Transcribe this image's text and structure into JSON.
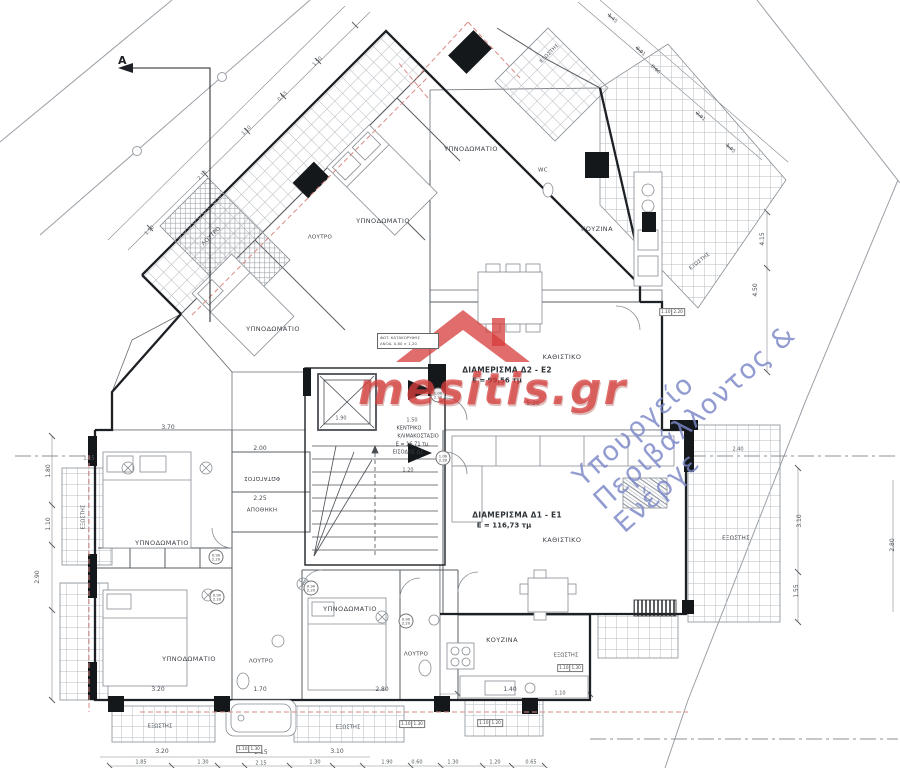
{
  "watermarks": {
    "brand": "mesitis.gr",
    "ministry": "Υπουργείο Περιβάλλοντος & Ενέργε",
    "brand_color": "#d63e3c",
    "ministry_color": "#7a86c7"
  },
  "section_marker": {
    "label": "A"
  },
  "annotation": {
    "line1": "ΦΩΤ. ΚΑΤΑΚΟΡΥΦΗΣ",
    "line2": "ΑΝΟΔ. 0,80 × 1,20"
  },
  "apartments": [
    {
      "name": "ΔΙΑΜΕΡΙΣΜΑ Δ2 - Ε2",
      "area": "Ε = 99,56 τμ"
    },
    {
      "name": "ΔΙΑΜΕΡΙΣΜΑ Δ1 - Ε1",
      "area": "Ε = 116,73 τμ"
    }
  ],
  "stair": {
    "name": "ΚΕΝΤΡΙΚΟ ΚΛΙΜΑΚΟΣΤΑΣΙΟ",
    "area": "Ε = 16,71 τμ",
    "entrance": "ΕΙΣΟΔΟΣ Δ1"
  },
  "labels": [
    {
      "name": "room-bedroom-u1",
      "text": "ΥΠΝΟΔΩΜΑΤΙΟ",
      "x": 273,
      "y": 329,
      "rot": 0,
      "cls": "room"
    },
    {
      "name": "room-bedroom-u2",
      "text": "ΥΠΝΟΔΩΜΑΤΙΟ",
      "x": 383,
      "y": 221,
      "rot": 0,
      "cls": "room"
    },
    {
      "name": "room-bedroom-u3",
      "text": "ΥΠΝΟΔΩΜΑΤΙΟ",
      "x": 471,
      "y": 149,
      "rot": 0,
      "cls": "room"
    },
    {
      "name": "room-bath-u1",
      "text": "ΛΟΥΤΡΟ",
      "x": 212,
      "y": 237,
      "rot": -45,
      "cls": "room-sm"
    },
    {
      "name": "room-bath-u2",
      "text": "ΛΟΥΤΡΟ",
      "x": 320,
      "y": 238,
      "rot": 0,
      "cls": "room-sm"
    },
    {
      "name": "room-wc-u",
      "text": "WC",
      "x": 543,
      "y": 171,
      "rot": 0,
      "cls": "room-sm"
    },
    {
      "name": "room-kitchen-u",
      "text": "ΚΟΥΖΙΝΑ",
      "x": 597,
      "y": 229,
      "rot": 0,
      "cls": "room"
    },
    {
      "name": "room-living-u",
      "text": "ΚΑΘΙΣΤΙΚΟ",
      "x": 562,
      "y": 357,
      "rot": 0,
      "cls": "room"
    },
    {
      "name": "balcony-top",
      "text": "ΕΞΩΣΤΗΣ",
      "x": 550,
      "y": 54,
      "rot": -45,
      "cls": "room-xs"
    },
    {
      "name": "balcony-ne",
      "text": "ΕΞΩΣΤΗΣ",
      "x": 700,
      "y": 262,
      "rot": -38,
      "cls": "room-xs"
    },
    {
      "name": "apartment-2-name",
      "text": "ΔΙΑΜΕΡΙΣΜΑ Δ2 - Ε2",
      "x": 507,
      "y": 370,
      "rot": 0,
      "cls": "apt"
    },
    {
      "name": "apartment-2-area",
      "text": "Ε = 99,56 τμ",
      "x": 497,
      "y": 381,
      "rot": 0,
      "cls": "apt2"
    },
    {
      "name": "apartment-1-name",
      "text": "ΔΙΑΜΕΡΙΣΜΑ Δ1 - Ε1",
      "x": 517,
      "y": 515,
      "rot": 0,
      "cls": "apt"
    },
    {
      "name": "apartment-1-area",
      "text": "Ε = 116,73 τμ",
      "x": 504,
      "y": 526,
      "rot": 0,
      "cls": "apt2"
    },
    {
      "name": "stair-label-1",
      "text": "ΚΕΝΤΡΙΚΟ",
      "x": 409,
      "y": 429,
      "rot": 0,
      "cls": "stairlb"
    },
    {
      "name": "stair-label-2",
      "text": "ΚΛΙΜΑΚΟΣΤΑΣΙΟ",
      "x": 418,
      "y": 437,
      "rot": 0,
      "cls": "stairlb"
    },
    {
      "name": "stair-label-3",
      "text": "Ε = 16,71 τμ",
      "x": 412,
      "y": 445,
      "rot": 0,
      "cls": "stairlb"
    },
    {
      "name": "stair-label-4",
      "text": "ΕΙΣΟΔΟΣ Δ1",
      "x": 408,
      "y": 453,
      "rot": 0,
      "cls": "stairlb"
    },
    {
      "name": "room-lightwell",
      "text": "ΦΩΤΑΓΩΓΟΣ",
      "x": 262,
      "y": 477,
      "rot": 180,
      "cls": "room-sm"
    },
    {
      "name": "room-storage",
      "text": "ΑΠΟΘΗΚΗ",
      "x": 262,
      "y": 511,
      "rot": 0,
      "cls": "room-sm"
    },
    {
      "name": "room-bedroom-l1",
      "text": "ΥΠΝΟΔΩΜΑΤΙΟ",
      "x": 162,
      "y": 543,
      "rot": 0,
      "cls": "room"
    },
    {
      "name": "room-bedroom-l2",
      "text": "ΥΠΝΟΔΩΜΑΤΙΟ",
      "x": 189,
      "y": 659,
      "rot": 0,
      "cls": "room"
    },
    {
      "name": "room-bath-l1",
      "text": "ΛΟΥΤΡΟ",
      "x": 261,
      "y": 662,
      "rot": 0,
      "cls": "room-sm"
    },
    {
      "name": "room-bedroom-l3",
      "text": "ΥΠΝΟΔΩΜΑΤΙΟ",
      "x": 350,
      "y": 609,
      "rot": 0,
      "cls": "room"
    },
    {
      "name": "room-bath-l2",
      "text": "ΛΟΥΤΡΟ",
      "x": 416,
      "y": 655,
      "rot": 0,
      "cls": "room-sm"
    },
    {
      "name": "room-kitchen-l",
      "text": "ΚΟΥΖΙΝΑ",
      "x": 502,
      "y": 640,
      "rot": 0,
      "cls": "room"
    },
    {
      "name": "room-living-l",
      "text": "ΚΑΘΙΣΤΙΚΟ",
      "x": 562,
      "y": 540,
      "rot": 0,
      "cls": "room"
    },
    {
      "name": "balcony-east",
      "text": "ΕΞΩΣΤΗΣ",
      "x": 736,
      "y": 539,
      "rot": 0,
      "cls": "room-sm"
    },
    {
      "name": "balcony-s1",
      "text": "ΕΞΩΣΤΗΣ",
      "x": 160,
      "y": 727,
      "rot": 0,
      "cls": "room-xs"
    },
    {
      "name": "balcony-s2",
      "text": "ΕΞΩΣΤΗΣ",
      "x": 348,
      "y": 728,
      "rot": 0,
      "cls": "room-xs"
    },
    {
      "name": "balcony-s3",
      "text": "ΕΞΩΣΤΗΣ",
      "x": 566,
      "y": 656,
      "rot": 0,
      "cls": "room-xs"
    },
    {
      "name": "balcony-west",
      "text": "ΕΞΩΣΤΗΣ",
      "x": 84,
      "y": 517,
      "rot": -90,
      "cls": "room-xs"
    },
    {
      "name": "dim",
      "text": "3.70",
      "x": 168,
      "y": 428,
      "rot": 0,
      "cls": "dim"
    },
    {
      "name": "dim",
      "text": "2.00",
      "x": 260,
      "y": 449,
      "rot": 0,
      "cls": "dim"
    },
    {
      "name": "dim",
      "text": "2.25",
      "x": 260,
      "y": 499,
      "rot": 0,
      "cls": "dim"
    },
    {
      "name": "dim",
      "text": "1.90",
      "x": 341,
      "y": 419,
      "rot": 0,
      "cls": "dim-sm"
    },
    {
      "name": "dim",
      "text": "1.20",
      "x": 408,
      "y": 471,
      "rot": 0,
      "cls": "dim-sm"
    },
    {
      "name": "dim",
      "text": "1.50",
      "x": 412,
      "y": 421,
      "rot": 0,
      "cls": "dim-sm"
    },
    {
      "name": "dim",
      "text": "5.30",
      "x": 533,
      "y": 404,
      "rot": 0,
      "cls": "dim"
    },
    {
      "name": "dim",
      "text": "3.20",
      "x": 158,
      "y": 690,
      "rot": 0,
      "cls": "dim"
    },
    {
      "name": "dim",
      "text": "1.70",
      "x": 260,
      "y": 690,
      "rot": 0,
      "cls": "dim"
    },
    {
      "name": "dim",
      "text": "2.80",
      "x": 382,
      "y": 690,
      "rot": 0,
      "cls": "dim"
    },
    {
      "name": "dim",
      "text": "1.40",
      "x": 510,
      "y": 690,
      "rot": 0,
      "cls": "dim"
    },
    {
      "name": "dim",
      "text": "1.10",
      "x": 560,
      "y": 694,
      "rot": 0,
      "cls": "dim-sm"
    },
    {
      "name": "dim",
      "text": "3.20",
      "x": 162,
      "y": 752,
      "rot": 0,
      "cls": "dim"
    },
    {
      "name": "dim",
      "text": "2.15",
      "x": 261,
      "y": 753,
      "rot": 0,
      "cls": "dim"
    },
    {
      "name": "dim",
      "text": "3.10",
      "x": 337,
      "y": 752,
      "rot": 0,
      "cls": "dim"
    },
    {
      "name": "dim",
      "text": "1.85",
      "x": 141,
      "y": 763,
      "rot": 0,
      "cls": "dim-sm"
    },
    {
      "name": "dim",
      "text": "1.30",
      "x": 203,
      "y": 763,
      "rot": 0,
      "cls": "dim-sm"
    },
    {
      "name": "dim",
      "text": "2.15",
      "x": 261,
      "y": 764,
      "rot": 0,
      "cls": "dim-sm"
    },
    {
      "name": "dim",
      "text": "1.30",
      "x": 315,
      "y": 763,
      "rot": 0,
      "cls": "dim-sm"
    },
    {
      "name": "dim",
      "text": "1.90",
      "x": 387,
      "y": 763,
      "rot": 0,
      "cls": "dim-sm"
    },
    {
      "name": "dim",
      "text": "0.60",
      "x": 417,
      "y": 763,
      "rot": 0,
      "cls": "dim-sm"
    },
    {
      "name": "dim",
      "text": "1.30",
      "x": 453,
      "y": 763,
      "rot": 0,
      "cls": "dim-sm"
    },
    {
      "name": "dim",
      "text": "1.20",
      "x": 495,
      "y": 763,
      "rot": 0,
      "cls": "dim-sm"
    },
    {
      "name": "dim",
      "text": "0.65",
      "x": 531,
      "y": 763,
      "rot": 0,
      "cls": "dim-sm"
    },
    {
      "name": "dim",
      "text": "1.80",
      "x": 49,
      "y": 471,
      "rot": -90,
      "cls": "dim"
    },
    {
      "name": "dim",
      "text": "1.10",
      "x": 49,
      "y": 524,
      "rot": -90,
      "cls": "dim"
    },
    {
      "name": "dim",
      "text": "2.90",
      "x": 38,
      "y": 577,
      "rot": -90,
      "cls": "dim"
    },
    {
      "name": "dim",
      "text": "1.15",
      "x": 89,
      "y": 459,
      "rot": 0,
      "cls": "dim-sm"
    },
    {
      "name": "dim",
      "text": "4.15",
      "x": 763,
      "y": 239,
      "rot": -90,
      "cls": "dim"
    },
    {
      "name": "dim",
      "text": "4.50",
      "x": 756,
      "y": 290,
      "rot": -90,
      "cls": "dim"
    },
    {
      "name": "dim",
      "text": "3.10",
      "x": 800,
      "y": 521,
      "rot": -90,
      "cls": "dim"
    },
    {
      "name": "dim",
      "text": "1.55",
      "x": 797,
      "y": 591,
      "rot": -90,
      "cls": "dim"
    },
    {
      "name": "dim",
      "text": "2.80",
      "x": 893,
      "y": 545,
      "rot": -90,
      "cls": "dim"
    },
    {
      "name": "dim",
      "text": "2.40",
      "x": 738,
      "y": 450,
      "rot": 0,
      "cls": "dim-sm"
    },
    {
      "name": "dim",
      "text": "1.50",
      "x": 150,
      "y": 231,
      "rot": -45,
      "cls": "dim-sm"
    },
    {
      "name": "dim",
      "text": "2.15",
      "x": 203,
      "y": 176,
      "rot": -45,
      "cls": "dim-sm"
    },
    {
      "name": "dim",
      "text": "1.10",
      "x": 247,
      "y": 131,
      "rot": -45,
      "cls": "dim-sm"
    },
    {
      "name": "dim",
      "text": "0.63",
      "x": 283,
      "y": 97,
      "rot": -45,
      "cls": "dim-sm"
    },
    {
      "name": "dim",
      "text": "1.50",
      "x": 318,
      "y": 62,
      "rot": -45,
      "cls": "dim-sm"
    },
    {
      "name": "dim",
      "text": "1.45",
      "x": 612,
      "y": 19,
      "rot": 42,
      "cls": "dim-sm"
    },
    {
      "name": "dim",
      "text": "0.91",
      "x": 640,
      "y": 52,
      "rot": 42,
      "cls": "dim-sm"
    },
    {
      "name": "dim",
      "text": "0.60",
      "x": 655,
      "y": 70,
      "rot": 42,
      "cls": "dim-sm"
    },
    {
      "name": "dim",
      "text": "2.91",
      "x": 700,
      "y": 117,
      "rot": 42,
      "cls": "dim-sm"
    },
    {
      "name": "dim",
      "text": "1.95",
      "x": 730,
      "y": 149,
      "rot": 42,
      "cls": "dim-sm"
    },
    {
      "name": "window-tag",
      "text": "1.10|1.30",
      "x": 249,
      "y": 749,
      "rot": 0,
      "cls": "tag"
    },
    {
      "name": "window-tag",
      "text": "1.10|1.30",
      "x": 412,
      "y": 724,
      "rot": 0,
      "cls": "tag"
    },
    {
      "name": "window-tag",
      "text": "1.10|1.20",
      "x": 490,
      "y": 723,
      "rot": 0,
      "cls": "tag"
    },
    {
      "name": "window-tag",
      "text": "1.10|1.30",
      "x": 570,
      "y": 668,
      "rot": 0,
      "cls": "tag"
    },
    {
      "name": "window-tag",
      "text": "1.10|2.20",
      "x": 672,
      "y": 312,
      "rot": 0,
      "cls": "tag"
    },
    {
      "name": "door-tag",
      "text": "1.00|2.20",
      "x": 438,
      "y": 395,
      "rot": 0,
      "cls": "dtag"
    },
    {
      "name": "door-tag",
      "text": "1.00|2.20",
      "x": 443,
      "y": 458,
      "rot": 0,
      "cls": "dtag"
    },
    {
      "name": "door-tag",
      "text": "0.90|2.20",
      "x": 216,
      "y": 557,
      "rot": 0,
      "cls": "dtag"
    },
    {
      "name": "door-tag",
      "text": "0.90|2.20",
      "x": 217,
      "y": 597,
      "rot": 0,
      "cls": "dtag"
    },
    {
      "name": "door-tag",
      "text": "0.90|2.20",
      "x": 311,
      "y": 588,
      "rot": 0,
      "cls": "dtag"
    },
    {
      "name": "door-tag",
      "text": "0.90|2.20",
      "x": 406,
      "y": 621,
      "rot": 0,
      "cls": "dtag"
    }
  ]
}
